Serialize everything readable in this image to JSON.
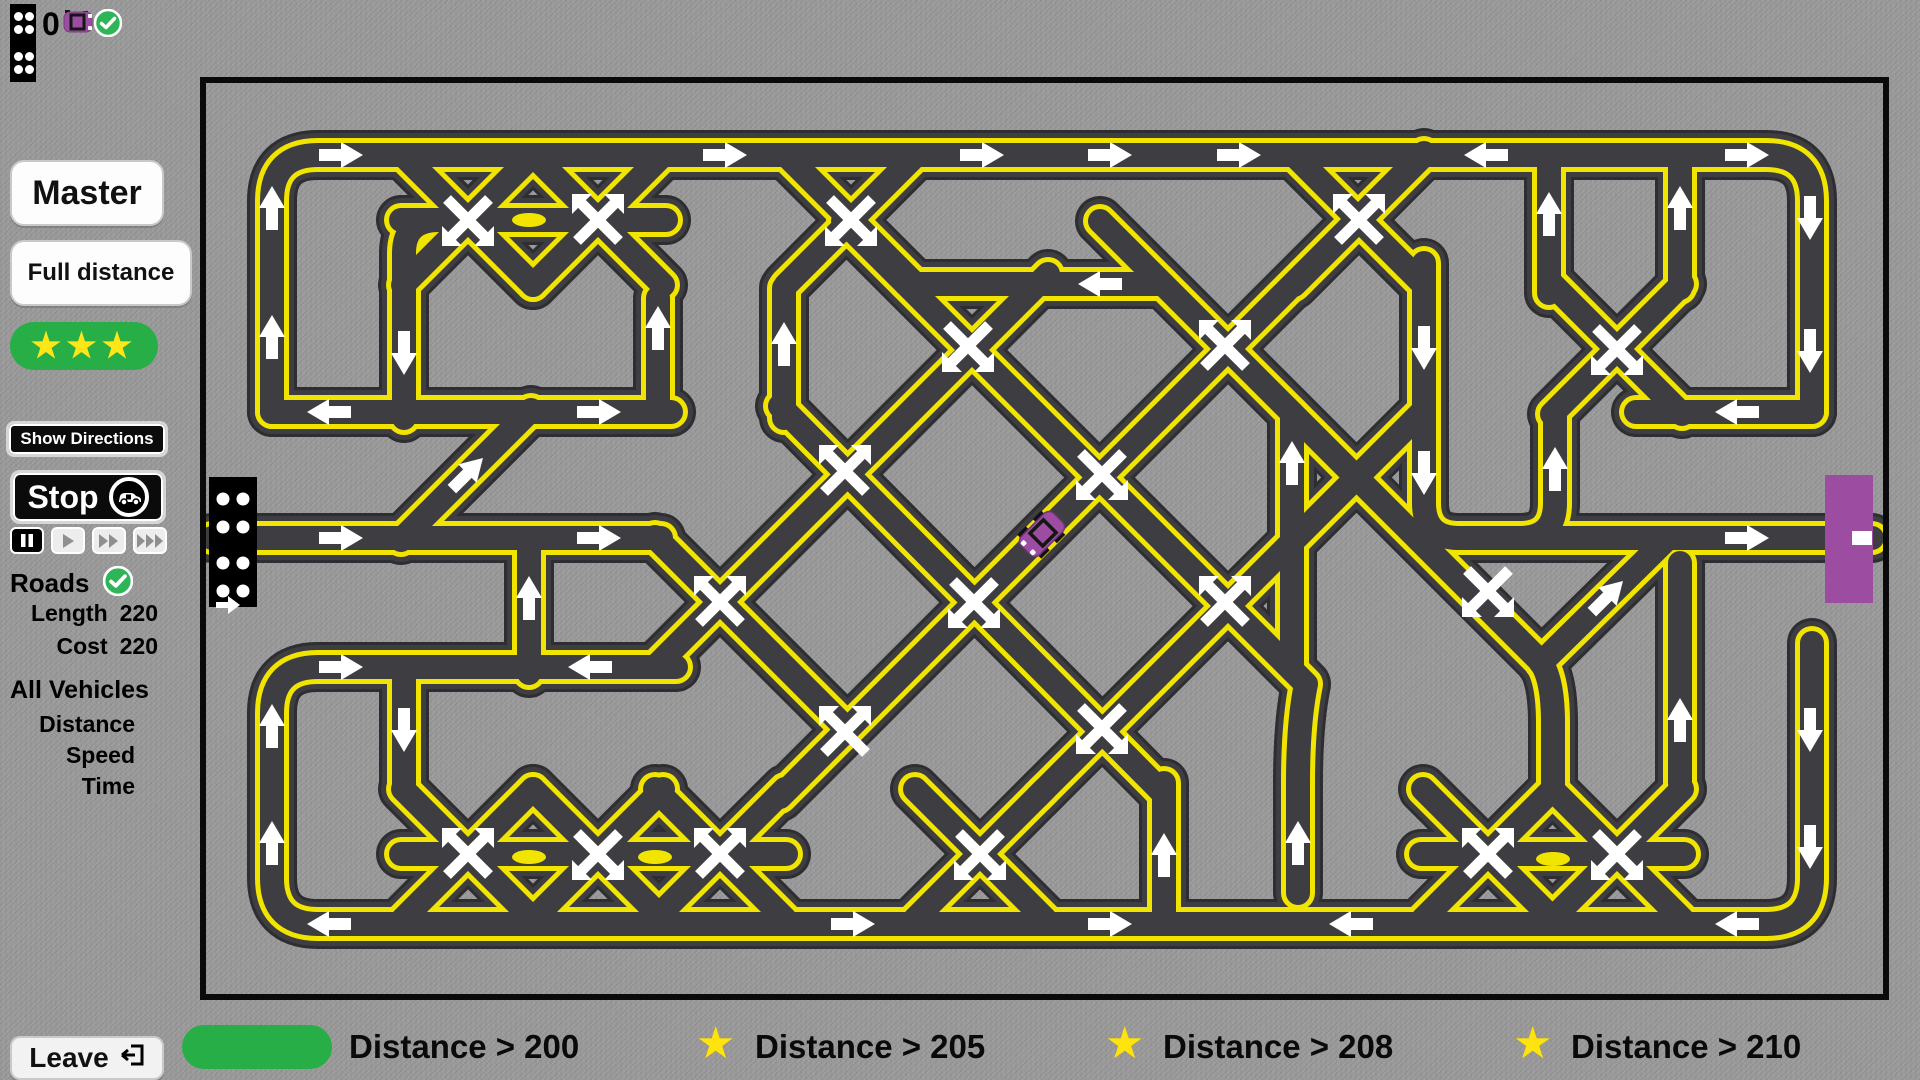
{
  "hud": {
    "vehicle_count": "0"
  },
  "sidebar": {
    "master": "Master",
    "full_distance": "Full distance",
    "stars": "★★★",
    "show_directions": "Show Directions",
    "stop": "Stop",
    "roads": "Roads",
    "length_label": "Length",
    "length_value": "220",
    "cost_label": "Cost",
    "cost_value": "220",
    "all_vehicles": "All Vehicles",
    "metric_distance": "Distance",
    "metric_speed": "Speed",
    "metric_time": "Time",
    "leave": "Leave"
  },
  "goals": {
    "star": "★",
    "g1": "Distance > 200",
    "g2": "Distance > 205",
    "g3": "Distance > 208",
    "g4": "Distance > 210"
  },
  "colors": {
    "background": "#9b9b9b",
    "road": "#3e3e42",
    "road_outline": "#2e2e32",
    "road_line": "#f1e500",
    "accent_green": "#27ae47",
    "accent_purple": "#9c4da1",
    "star_yellow": "#ffe617",
    "marker_white": "#ffffff"
  }
}
